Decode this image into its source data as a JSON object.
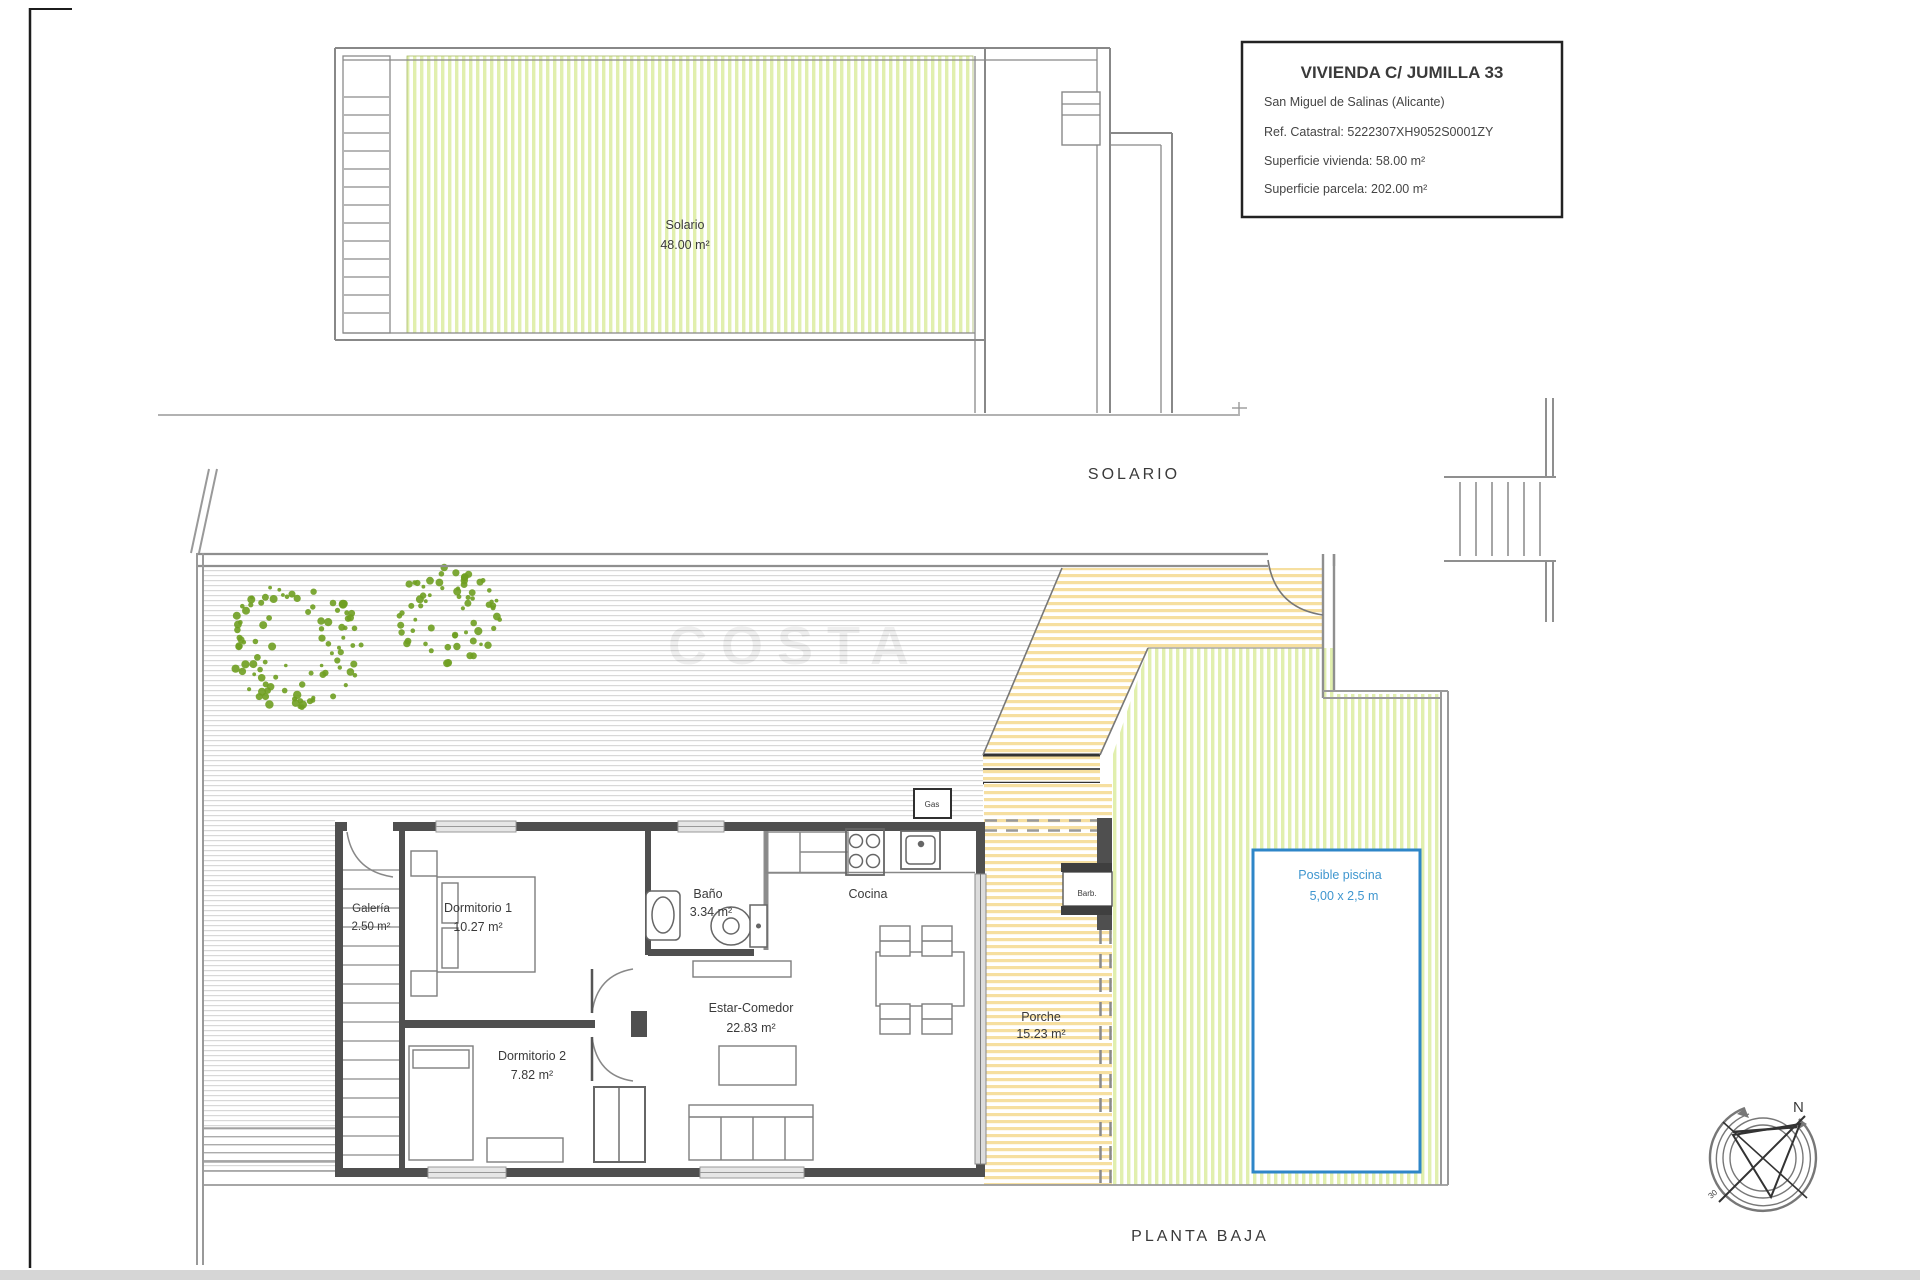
{
  "title_block": {
    "title": "VIVIENDA C/ JUMILLA 33",
    "location": "San Miguel de Salinas (Alicante)",
    "ref_catastral": "Ref. Catastral: 5222307XH9052S0001ZY",
    "superficie_vivienda": "Superficie vivienda: 58.00 m²",
    "superficie_parcela": "Superficie parcela: 202.00 m²"
  },
  "sections": {
    "roof_label": "SOLARIO",
    "ground_label": "PLANTA BAJA"
  },
  "rooms": {
    "solario": {
      "name": "Solario",
      "area": "48.00 m²"
    },
    "galeria": {
      "name": "Galería",
      "area": "2.50 m²"
    },
    "dormitorio1": {
      "name": "Dormitorio 1",
      "area": "10.27 m²"
    },
    "bano": {
      "name": "Baño",
      "area": "3.34 m²"
    },
    "cocina": {
      "name": "Cocina"
    },
    "estar_comedor": {
      "name": "Estar-Comedor",
      "area": "22.83 m²"
    },
    "dormitorio2": {
      "name": "Dormitorio 2",
      "area": "7.82 m²"
    },
    "porche": {
      "name": "Porche",
      "area": "15.23 m²"
    }
  },
  "pool": {
    "label": "Posible piscina",
    "size": "5,00 x 2,5 m"
  },
  "annotations": {
    "gas": "Gas",
    "barbecue": "Barb.",
    "compass_north": "N",
    "compass_degrees": "30"
  },
  "watermark": "COSTA",
  "colors": {
    "garden_hatch": "#e1efae",
    "path_hatch": "#f6dfa0",
    "patio_hatch": "#d8d8d8",
    "pool_outline": "#2e86c8",
    "tree_green": "#6f9e21",
    "wall_dark": "#4f4f4f"
  }
}
